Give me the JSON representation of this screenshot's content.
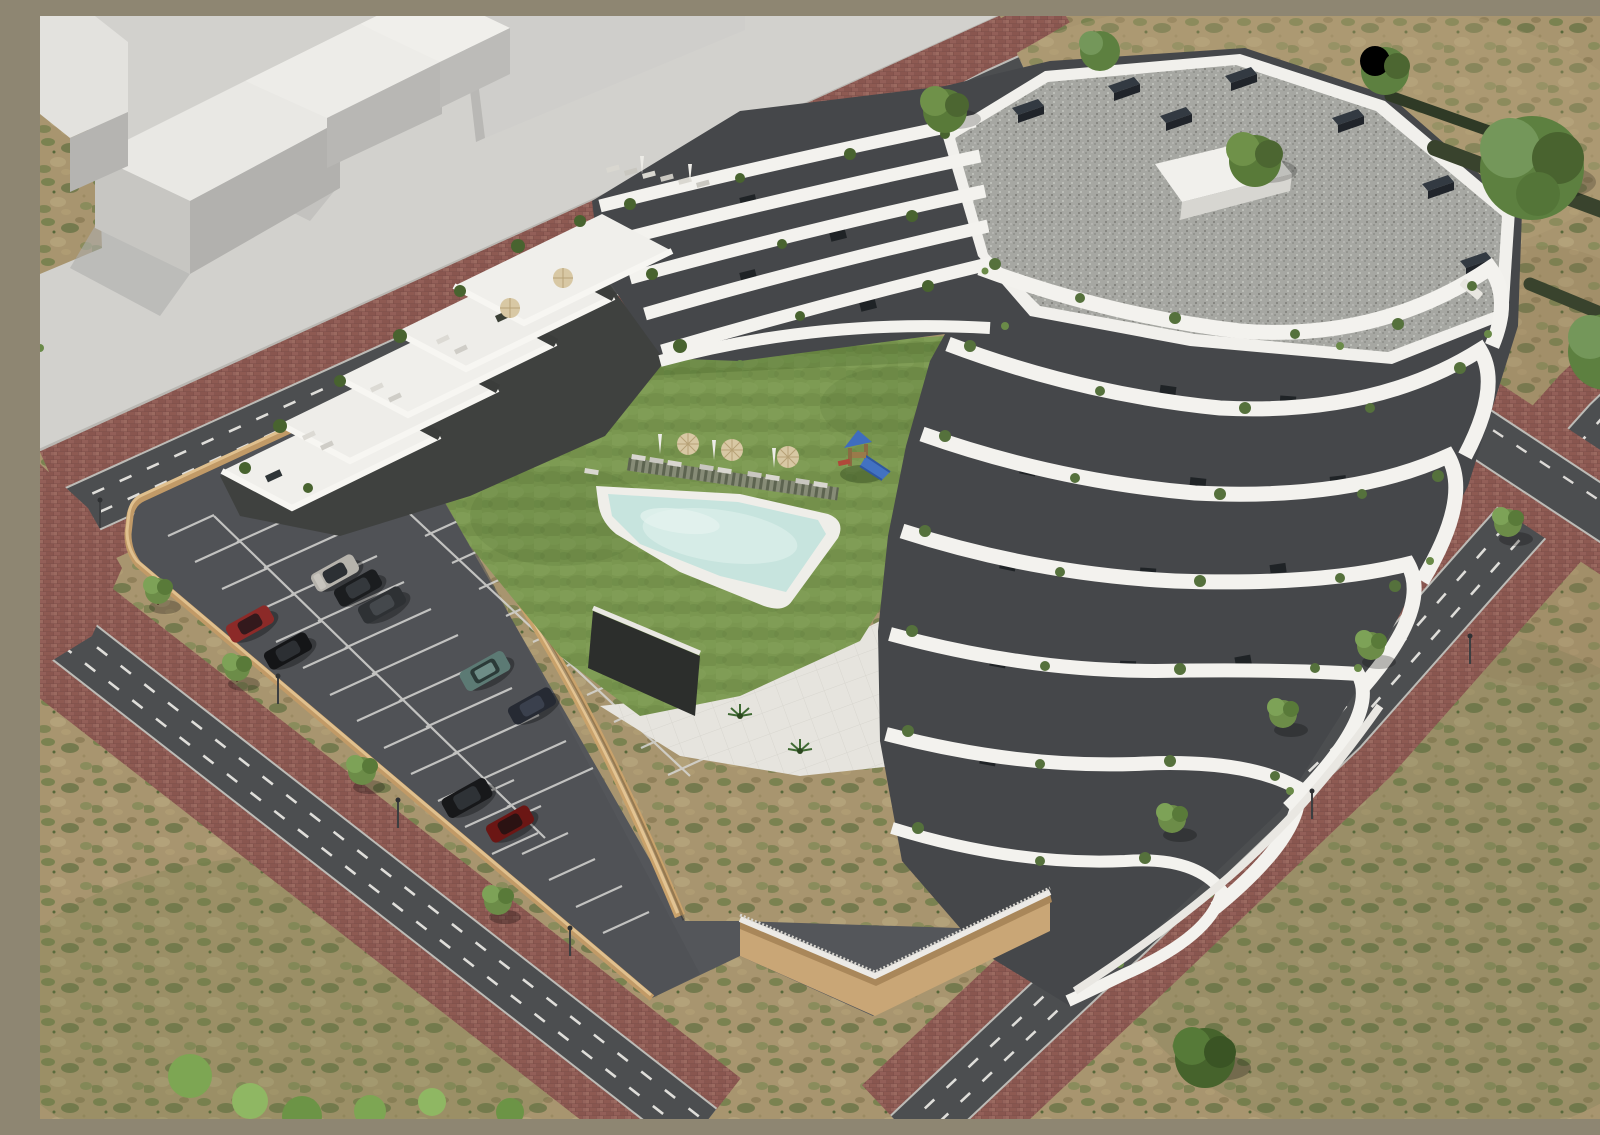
{
  "meta": {
    "caption": "Aerial 3D architectural rendering of a modern white terraced apartment complex with curved balcony bands, a landscaped courtyard with lawn, free-form swimming pool, playground and sun loungers, a fenced surface parking lot with cars, and surrounding roads with red brick sidewalks amid dry scrubland.",
    "aria_label": "Aerial rendering of terraced apartment building with courtyard pool and parking",
    "render_type": "3D exterior architectural rendering"
  },
  "palette": {
    "building_white": "#f3f2ee",
    "facade_recess": "#3f4140",
    "roof_gravel": "#a6a7a2",
    "vent_box": "#2b3138",
    "lawn_green": "#7a9750",
    "pool_water": "#c7e4de",
    "pool_rim": "#efeee9",
    "asphalt_road": "#4c4e50",
    "parking_asphalt": "#54565a",
    "brick_paving": "#8a5751",
    "retaining_wall_tan": "#c9a26b",
    "scrubland": "#a8956f",
    "concrete_plaza": "#d6d5d0",
    "massing_block_top": "#e9e8e4",
    "tree_green": "#6c8c48",
    "lane_marking": "#eceae6",
    "playground_blue": "#3f6dbe",
    "playground_red": "#b0483a",
    "parasol_tan": "#d8c8a4"
  },
  "scene": {
    "context_buildings": {
      "label": "abstract white massing blocks",
      "count": 4
    },
    "main_building": {
      "label": "terraced apartment building",
      "visible_floors": 6,
      "roof": "grey gravel flat roof with dark vent stacks and penthouse volume",
      "balcony_style": "organic curved white bands with planted terraces"
    },
    "courtyard": {
      "lawn": true,
      "pool": {
        "shape": "irregular free-form",
        "water": "#c7e4de"
      },
      "wood_deck": true,
      "playground": {
        "colors": [
          "#3f6dbe",
          "#b0483a"
        ]
      },
      "sun_loungers": 12,
      "parasols_open": 3,
      "parasols_closed": 3
    },
    "parking": {
      "marked_bays": true,
      "cars": [
        {
          "color_name": "silver",
          "hex": "#b6b3ac"
        },
        {
          "color_name": "black",
          "hex": "#1b1d1f"
        },
        {
          "color_name": "graphite",
          "hex": "#2e3134"
        },
        {
          "color_name": "red",
          "hex": "#8c2a28"
        },
        {
          "color_name": "black",
          "hex": "#141517"
        },
        {
          "color_name": "teal-suv",
          "hex": "#5c7a74"
        },
        {
          "color_name": "navy",
          "hex": "#262a33"
        },
        {
          "color_name": "black-suv",
          "hex": "#17181a"
        },
        {
          "color_name": "dark-red",
          "hex": "#6b1614"
        }
      ]
    },
    "streets": {
      "roads": 4,
      "lane_markings": "white dashed lines",
      "sidewalks": "red brick pavers",
      "street_trees": 9,
      "street_lamps": 6
    }
  }
}
